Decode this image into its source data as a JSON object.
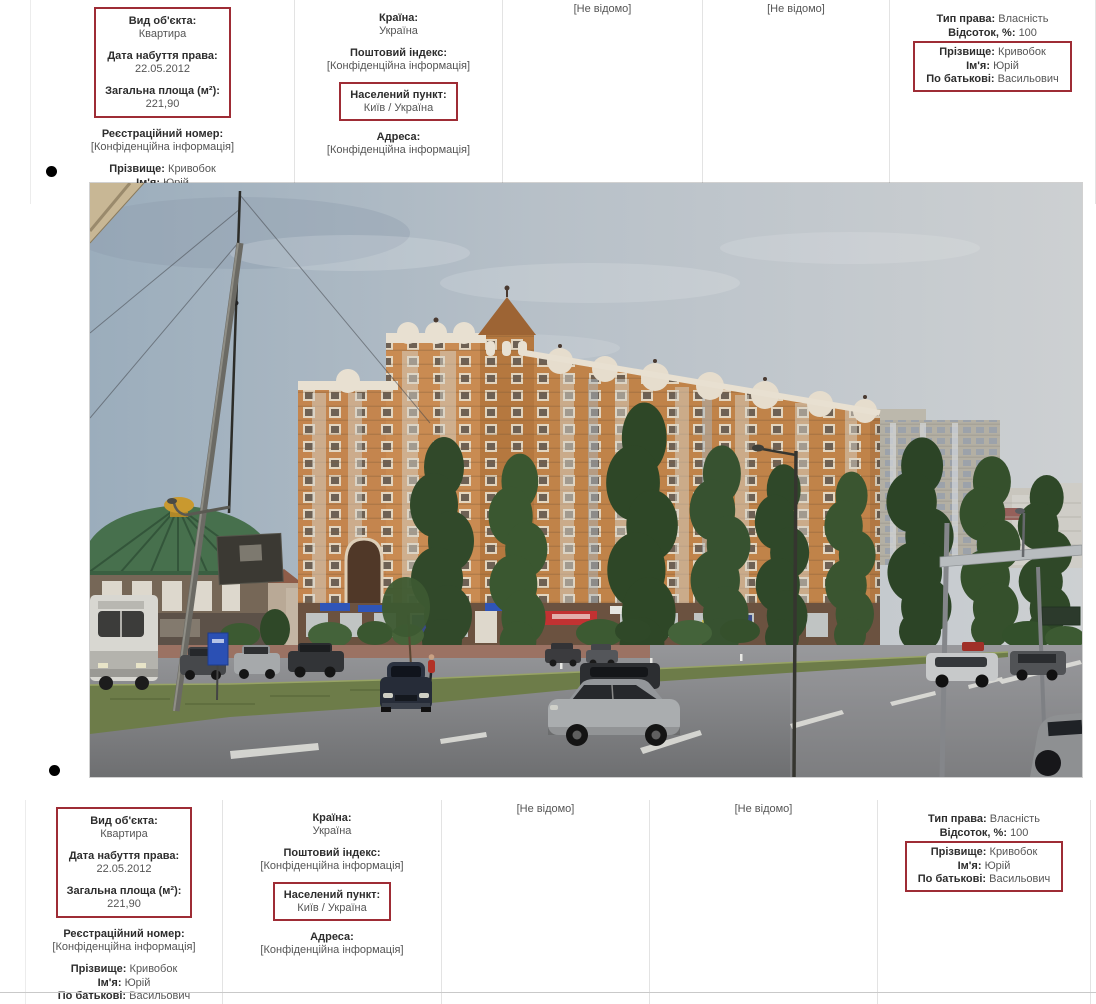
{
  "record": {
    "object": {
      "type_label": "Вид об'єкта:",
      "type_value": "Квартира",
      "date_label": "Дата набуття права:",
      "date_value": "22.05.2012",
      "area_label": "Загальна площа (м²):",
      "area_value": "221,90",
      "regnum_label": "Реєстраційний номер:",
      "regnum_value": "[Конфіденційна інформація]",
      "surname_label": "Прізвище:",
      "surname_value": "Кривобок",
      "name_label": "Ім'я:",
      "name_value": "Юрій",
      "patronymic_label": "По батькові:",
      "patronymic_value": "Васильович"
    },
    "location": {
      "country_label": "Країна:",
      "country_value": "Україна",
      "postal_label": "Поштовий індекс:",
      "postal_value": "[Конфіденційна інформація]",
      "city_label": "Населений пункт:",
      "city_value": "Київ / Україна",
      "address_label": "Адреса:",
      "address_value": "[Конфіденційна інформація]"
    },
    "col3_text": "[Не відомо]",
    "col4_text": "[Не відомо]",
    "rights": {
      "type_label": "Тип права:",
      "type_value": "Власність",
      "percent_label": "Відсоток, %:",
      "percent_value": "100",
      "surname_label": "Прізвище:",
      "surname_value": "Кривобок",
      "name_label": "Ім'я:",
      "name_value": "Юрій",
      "patronymic_label": "По батькові:",
      "patronymic_value": "Васильович"
    }
  },
  "colors": {
    "highlight_box": "#9e2c35",
    "divider": "#e3e3e3",
    "label_text": "#2d2d2d",
    "value_text": "#555555",
    "bullet": "#000000",
    "photo_sky": "#b7c0c8",
    "photo_building": "#c4854e",
    "photo_road": "#85868a",
    "photo_grass": "#6d7c49",
    "photo_trees": "#35502c",
    "photo_dome": "#47704d"
  }
}
